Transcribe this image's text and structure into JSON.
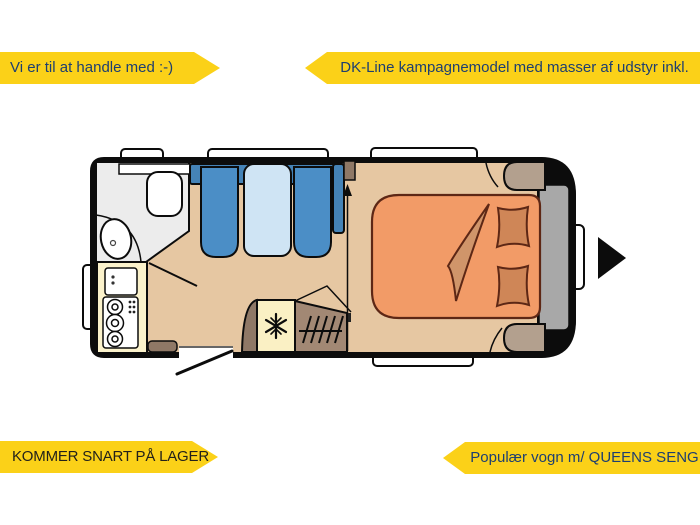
{
  "banners": {
    "top_left": "Vi er til at handle med :-)",
    "top_right": "DK-Line kampagnemodel med masser af udstyr inkl.",
    "bottom_left": "KOMMER SNART PÅ LAGER",
    "bottom_right": "Populær vogn m/ QUEENS SENG"
  },
  "colors": {
    "banner_yellow": "#fbd118",
    "banner_text_blue": "#1d3e71",
    "banner_text_dark": "#23211a",
    "floor_tan": "#e6c7a2",
    "wall_black": "#0c0c0c",
    "bench_blue": "#4b8ec6",
    "backrest_blue": "#4583b7",
    "table_blue": "#cfe4f4",
    "bathroom_grey": "#ececec",
    "kitchen_cream": "#fbf2cb",
    "fridge_cream": "#faf0c4",
    "wardrobe_taupe": "#a28874",
    "cabinet_brown": "#8f7866",
    "shelf_taupe": "#b3a08e",
    "headboard_grey": "#a8a8a8",
    "mattress_orange": "#f29b67",
    "pillow_orange": "#cf8657",
    "blanket_tan": "#d0956a",
    "bedding_outline": "#5d2715"
  },
  "floorplan": {
    "description": "Caravan floor plan, top-down view",
    "elements": [
      "windows",
      "bathroom",
      "toilet",
      "washbasin",
      "kitchen-sink",
      "stove-3-burner",
      "dinette-bench-left",
      "dinette-bench-right",
      "dinette-table",
      "refrigerator",
      "wardrobe",
      "entrance-door",
      "queens-bed",
      "pillows",
      "blanket",
      "front-direction-arrow"
    ]
  }
}
